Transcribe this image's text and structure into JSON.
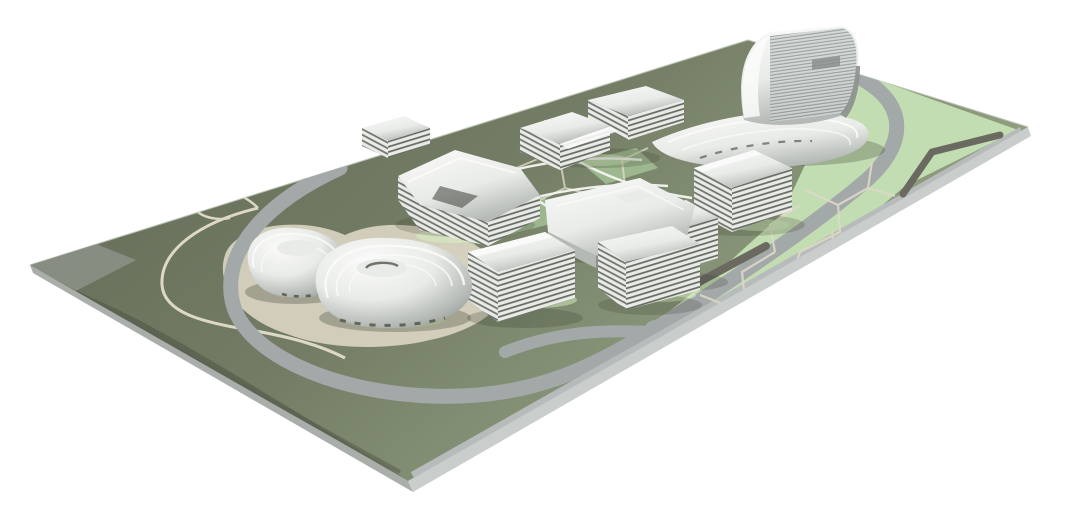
{
  "meta": {
    "title": "Rendered architectural site model",
    "description": "3D rendering of a physical architectural masterplan model on a white background: a thin chamfered base plate in perspective carrying olive-green and pastel-green landscape, gray ring roads, cream pedestrian paths, a dark water channel, clusters of chrome-metallic terraced buildings, two shell-shaped spiral buildings at the left, a large white hall in the center and a tall sculptural louvered tower at the far corner.",
    "view": "isometric-style perspective, plate tilted, white studio background",
    "text_content_visible": "none"
  },
  "colors": {
    "bg": "#ffffff",
    "plate_rim": "#b9bfb2",
    "plate_side_mid": "#a9aeab",
    "plate_side_light": "#c9cdcc",
    "ground_olive": "#646c57",
    "ground_mid": "#737d65",
    "ground_light": "#8b987b",
    "ground_sheen": "#a3b18d",
    "ground_dark": "#4f5646",
    "corner_wedge": "#8d9288",
    "edge_dark": "#5a6052",
    "lawn": "#c3ddb3",
    "lawn_soft": "#a6c497",
    "lawn_glow": "#d8f3c3",
    "road": "#a3a8a9",
    "road_margin": "#b7bbbb",
    "channel_dark": "#6a6a60",
    "path_cream": "#ded9c7",
    "plaza_cream": "#d7d2c0",
    "chrome_white": "#fafbfa",
    "chrome_light": "#e9ebe8",
    "chrome_mid": "#b4b9b5",
    "chrome_dark": "#8b908c",
    "stripe_dark": "#565b50",
    "slit_dark": "#3d4239",
    "shadow": "#39402f",
    "walkway_white": "#f5f7f3",
    "louver_light": "#cfd4d2",
    "louver_dark": "#878d8b"
  }
}
